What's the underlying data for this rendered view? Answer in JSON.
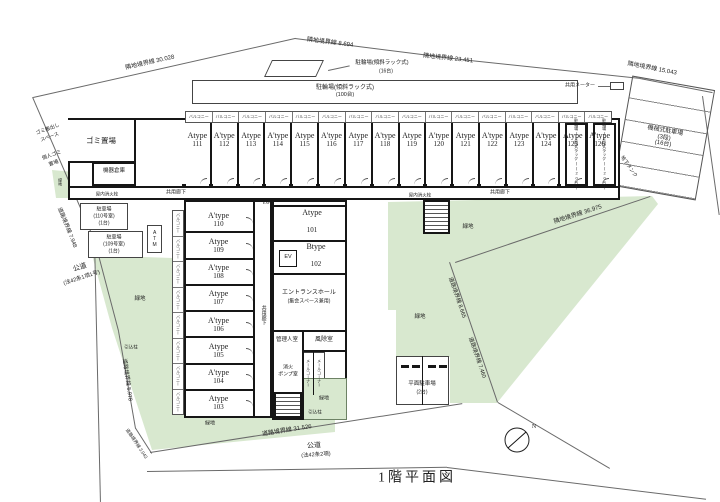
{
  "title": "1階平面図",
  "colors": {
    "green": "#d8e8cf",
    "wall": "#161616",
    "line": "#6a6a6a"
  },
  "top_units": [
    {
      "type": "Atype",
      "no": "111"
    },
    {
      "type": "A'type",
      "no": "112"
    },
    {
      "type": "Atype",
      "no": "113"
    },
    {
      "type": "A'type",
      "no": "114"
    },
    {
      "type": "Atype",
      "no": "115"
    },
    {
      "type": "A'type",
      "no": "116"
    },
    {
      "type": "Atype",
      "no": "117"
    },
    {
      "type": "A'type",
      "no": "118"
    },
    {
      "type": "Atype",
      "no": "119"
    },
    {
      "type": "A'type",
      "no": "120"
    },
    {
      "type": "Atype",
      "no": "121"
    },
    {
      "type": "A'type",
      "no": "122"
    },
    {
      "type": "Atype",
      "no": "123"
    },
    {
      "type": "A'type",
      "no": "124"
    },
    {
      "type": "Atype",
      "no": "125"
    },
    {
      "type": "A'type",
      "no": "126"
    }
  ],
  "left_units": [
    {
      "type": "A'type",
      "no": "110"
    },
    {
      "type": "Atype",
      "no": "109"
    },
    {
      "type": "A'type",
      "no": "108"
    },
    {
      "type": "Atype",
      "no": "107"
    },
    {
      "type": "A'type",
      "no": "106"
    },
    {
      "type": "Atype",
      "no": "105"
    },
    {
      "type": "A'type",
      "no": "104"
    },
    {
      "type": "Atype",
      "no": "103"
    }
  ],
  "center_units": [
    {
      "type": "Atype",
      "no": "101"
    },
    {
      "type": "Btype",
      "no": "102"
    }
  ],
  "boundaries": {
    "nb1": "隣地境界線 30.028",
    "nb2": "隣地境界線 8.694",
    "nb3": "隣地境界線 23.451",
    "nb4": "隣地境界線 15.043",
    "nb5": "隣地境界線 36.975",
    "rb1": "道路境界線 31.526",
    "rb2": "道路境界線 5.978",
    "rb3": "道路境界線 7.948",
    "rb4": "道路境界線 3.043",
    "rb5": "道路境界線 8.665",
    "rb6": "道路境界線 7.460"
  },
  "roads": {
    "left1": "公道",
    "left2": "(法42条1項1号)",
    "bottom1": "公道",
    "bottom2": "(法42条2項)"
  },
  "site": {
    "bike100_1": "駐輪場(傾斜ラック式)",
    "bike100_2": "(100台)",
    "bike16_1": "駐輪場(傾斜ラック式)",
    "bike16_2": "(16台)",
    "mech1": "機械式駐車場",
    "mech2": "(3段)",
    "mech3": "(16台)",
    "flat1": "平面駐車場",
    "flat2": "(2台)",
    "p110_1": "駐車場",
    "p110_2": "(110号室)",
    "p110_3": "(1台)",
    "p109_1": "駐車場",
    "p109_2": "(109号室)",
    "p109_3": "(1台)",
    "meter": "共用メーター",
    "tank": "地下タンク",
    "green": "緑地",
    "pole": "引込柱",
    "north": "N"
  },
  "rooms": {
    "garbage": "ゴミ置場",
    "equip": "機器倉庫",
    "gomi_out1": "ゴミ搬出し",
    "gomi_out2": "スペース",
    "personal1": "個人ゴミ",
    "personal2": "置場",
    "bikeroom": "駐輪場(2段式ラック)(20台)",
    "entrance1": "エントランスホール",
    "entrance2": "(集会スペース兼用)",
    "windbreak": "風除室",
    "manager": "管理人室",
    "mail": "メールコーナー",
    "pump1": "消火",
    "pump2": "ポンプ室",
    "ev": "EV",
    "atm": "ATM",
    "hydrant": "屋内消火栓",
    "corridor": "共用廊下",
    "balcony": "バルコニー",
    "expj": "EXP.J"
  }
}
